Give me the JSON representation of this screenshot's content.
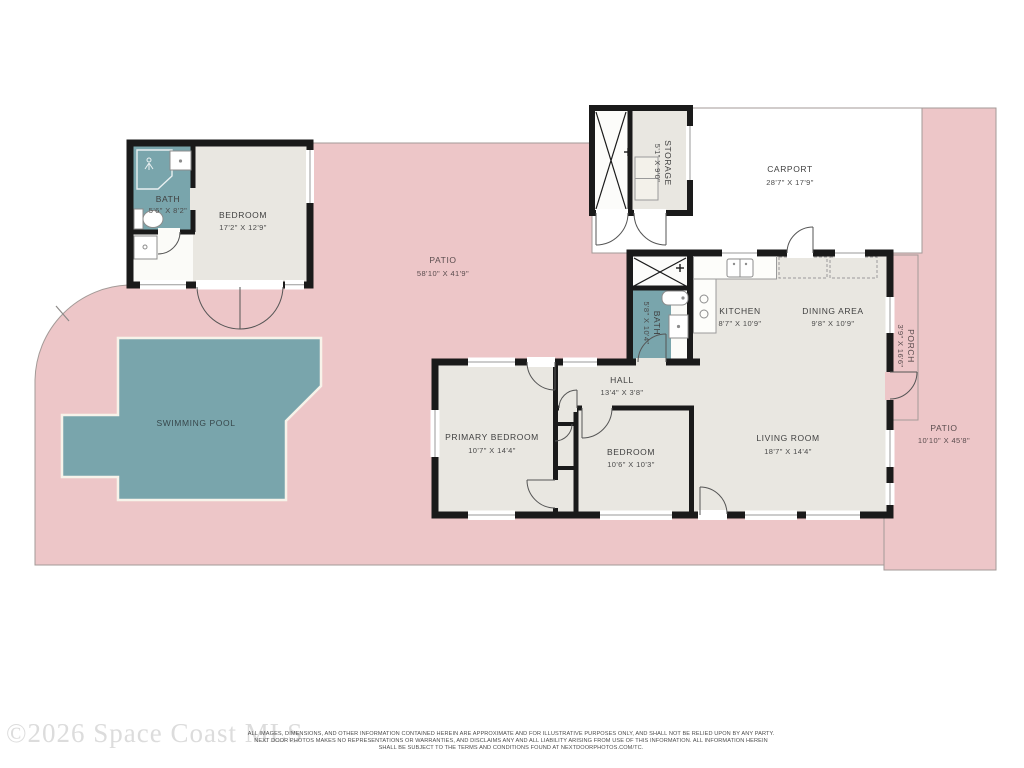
{
  "watermark": "©2026 Space Coast MLS",
  "footer": {
    "line1": "ALL IMAGES, DIMENSIONS, AND OTHER INFORMATION CONTAINED HEREIN ARE APPROXIMATE AND FOR ILLUSTRATIVE PURPOSES ONLY, AND SHALL NOT BE RELIED UPON BY ANY PARTY.",
    "line2": "NEXT DOOR PHOTOS MAKES NO REPRESENTATIONS OR WARRANTIES, AND DISCLAIMS ANY AND ALL LIABILITY ARISING FROM USE OF THIS INFORMATION. ALL INFORMATION HEREIN",
    "line3": "SHALL BE SUBJECT TO THE TERMS AND CONDITIONS FOUND AT NEXTDOORPHOTOS.COM/TC."
  },
  "colors": {
    "patio": "#edc6c8",
    "patio_outline": "#a39a97",
    "pool": "#79a5ac",
    "pool_rim": "#f7f3ea",
    "room": "#e9e7e1",
    "bath": "#79a5ac",
    "carport": "#ffffff",
    "closet_white": "#fcfcfa",
    "wall": "#1a1a1a",
    "fixture_line": "#8c8c8c"
  },
  "rooms": {
    "bath1": {
      "name": "BATH",
      "dims": "5'6\" X 8'2\""
    },
    "bedroom1": {
      "name": "BEDROOM",
      "dims": "17'2\" X 12'9\""
    },
    "storage": {
      "name": "STORAGE",
      "dims": "5'1\" X 9'0\""
    },
    "carport": {
      "name": "CARPORT",
      "dims": "28'7\" X 17'9\""
    },
    "kitchen": {
      "name": "KITCHEN",
      "dims": "8'7\" X 10'9\""
    },
    "dining": {
      "name": "DINING AREA",
      "dims": "9'8\" X 10'9\""
    },
    "bath2": {
      "name": "BATH",
      "dims": "5'8\" X 10'4\""
    },
    "hall": {
      "name": "HALL",
      "dims": "13'4\" X 3'8\""
    },
    "primary_bedroom": {
      "name": "PRIMARY BEDROOM",
      "dims": "10'7\" X 14'4\""
    },
    "bedroom2": {
      "name": "BEDROOM",
      "dims": "10'6\" X 10'3\""
    },
    "living": {
      "name": "LIVING ROOM",
      "dims": "18'7\" X 14'4\""
    },
    "porch": {
      "name": "PORCH",
      "dims": "3'9\" X 16'6\""
    },
    "patio_main": {
      "name": "PATIO",
      "dims": "58'10\" X 41'9\""
    },
    "patio_right": {
      "name": "PATIO",
      "dims": "10'10\" X 45'8\""
    },
    "pool": {
      "name": "SWIMMING POOL"
    }
  }
}
